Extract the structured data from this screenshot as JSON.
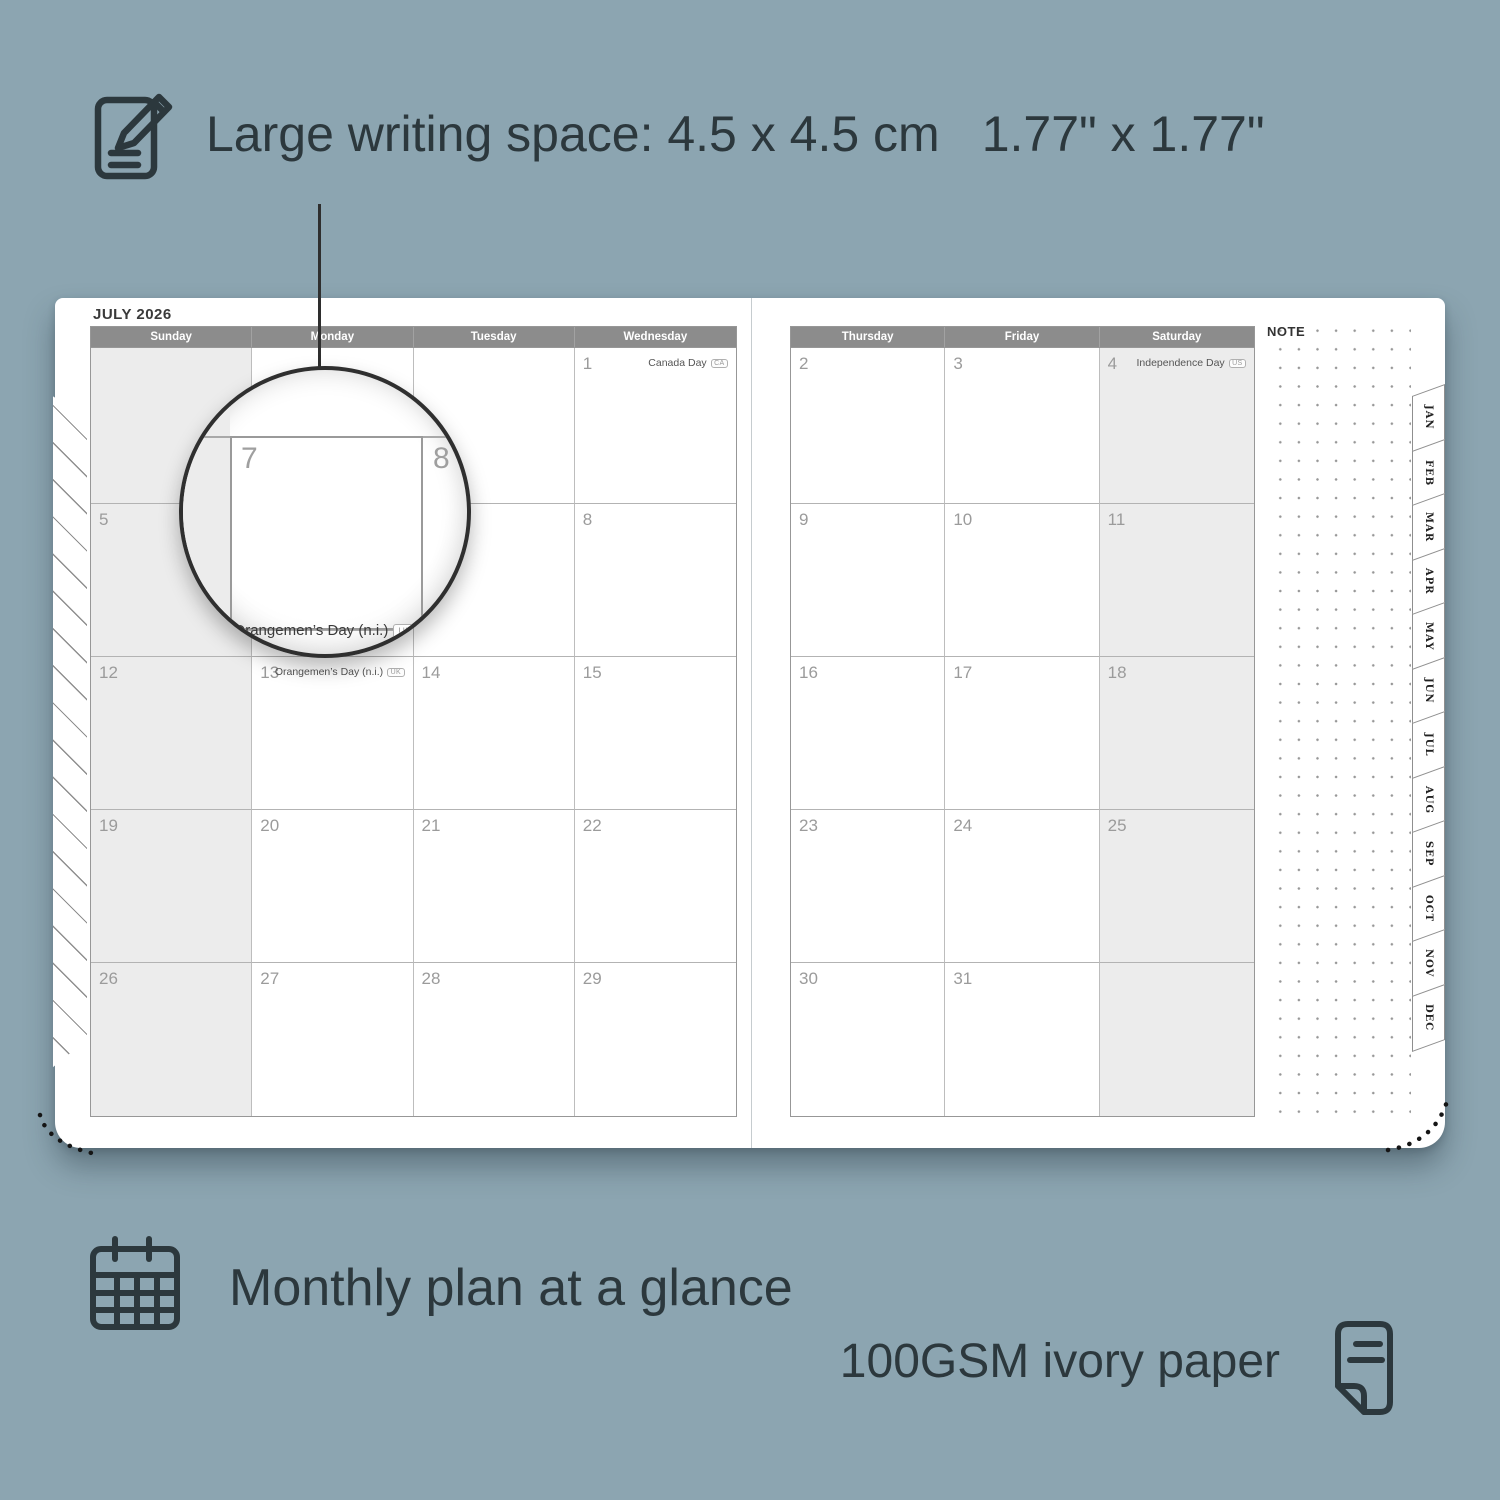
{
  "colors": {
    "background": "#8ca5b1",
    "ink": "#2c383d",
    "calendar_header_bar": "#8c8c8c",
    "shaded_column": "#ececec"
  },
  "feature_writing_space": {
    "icon": "notepad-pencil-icon",
    "text_metric": "Large writing space: 4.5 x 4.5 cm",
    "text_imperial": "1.77\" x 1.77\""
  },
  "planner": {
    "month_title": "JULY 2026",
    "note_label": "NOTE",
    "left_page": {
      "headers": [
        "Sunday",
        "Monday",
        "Tuesday",
        "Wednesday"
      ],
      "shaded_col": 0,
      "rows": [
        [
          {
            "day": ""
          },
          {
            "day": ""
          },
          {
            "day": ""
          },
          {
            "day": "1",
            "holiday": "Canada Day",
            "badge": "CA"
          }
        ],
        [
          {
            "day": "5"
          },
          {
            "day": "6"
          },
          {
            "day": "7"
          },
          {
            "day": "8"
          }
        ],
        [
          {
            "day": "12"
          },
          {
            "day": "13",
            "holiday": "Orangemen’s Day (n.i.)",
            "badge": "UK"
          },
          {
            "day": "14"
          },
          {
            "day": "15"
          }
        ],
        [
          {
            "day": "19"
          },
          {
            "day": "20"
          },
          {
            "day": "21"
          },
          {
            "day": "22"
          }
        ],
        [
          {
            "day": "26"
          },
          {
            "day": "27"
          },
          {
            "day": "28"
          },
          {
            "day": "29"
          }
        ]
      ]
    },
    "right_page": {
      "headers": [
        "Thursday",
        "Friday",
        "Saturday"
      ],
      "shaded_col": 2,
      "rows": [
        [
          {
            "day": "2"
          },
          {
            "day": "3"
          },
          {
            "day": "4",
            "holiday": "Independence Day",
            "badge": "US"
          }
        ],
        [
          {
            "day": "9"
          },
          {
            "day": "10"
          },
          {
            "day": "11"
          }
        ],
        [
          {
            "day": "16"
          },
          {
            "day": "17"
          },
          {
            "day": "18"
          }
        ],
        [
          {
            "day": "23"
          },
          {
            "day": "24"
          },
          {
            "day": "25"
          }
        ],
        [
          {
            "day": "30"
          },
          {
            "day": "31"
          },
          {
            "day": ""
          }
        ]
      ]
    },
    "month_tabs": [
      "JAN",
      "FEB",
      "MAR",
      "APR",
      "MAY",
      "JUN",
      "JUL",
      "AUG",
      "SEP",
      "OCT",
      "NOV",
      "DEC"
    ],
    "magnifier": {
      "day_a": "7",
      "day_b": "8",
      "holiday": "Orangemen’s Day (n.i.)",
      "badge": "UK"
    }
  },
  "feature_monthly": {
    "icon": "calendar-grid-icon",
    "text": "Monthly plan at a glance"
  },
  "feature_paper": {
    "icon": "paper-sheet-icon",
    "text": "100GSM ivory paper"
  }
}
